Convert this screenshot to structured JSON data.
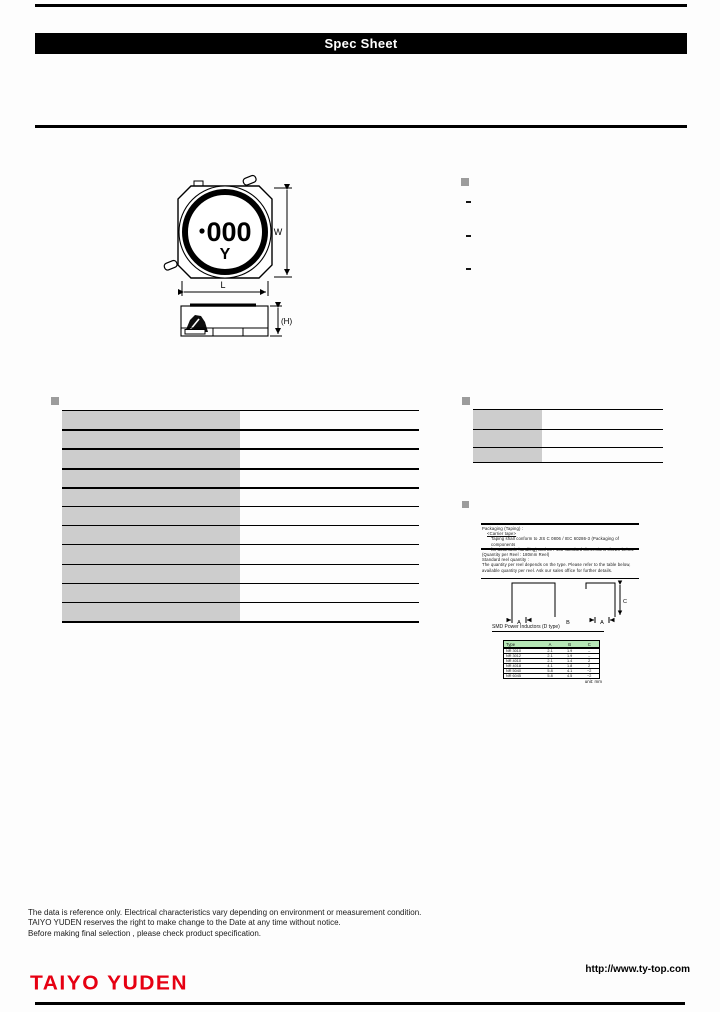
{
  "titlebar": {
    "label": "Spec Sheet"
  },
  "drawing": {
    "marking_dot": "•",
    "marking_code": "000",
    "marking_letter": "Y",
    "dim_width_label": "W",
    "dim_length_label": "L",
    "dim_height_label": "(H)"
  },
  "side_notes": {
    "dash1": "-",
    "dash2": "-",
    "dash3": "-"
  },
  "packaging": {
    "intro_lines": [
      "Packaging (Taping) :",
      "<Carrier tape>",
      "Taping shall conform to JIS C 0806 / IEC 60286-3 (Packaging of components",
      "for automatic handling) and EIA-481 standard dimensions shown below."
    ],
    "quantity_lines": [
      "(Quantity per Reel : 180mm Reel)",
      "Standard reel quantity :",
      "The quantity per reel depends on the type. Please refer to the table below,",
      "available quantity per reel. Ask our sales office for further details."
    ],
    "diagram": {
      "dim_a_left": "A",
      "dim_b": "B",
      "dim_a_right": "A",
      "dim_c": "C"
    },
    "table_title": "SMD Power Inductors (D type)",
    "table": {
      "headers": [
        "Type",
        "A",
        "B",
        "C"
      ],
      "rows": [
        [
          "NR 3010",
          "2.1",
          "1.9",
          "–"
        ],
        [
          "NR 3012",
          "2.1",
          "1.9",
          "–"
        ],
        [
          "NR 4010",
          "2.1",
          "1.4",
          "2"
        ],
        [
          "NR 4018",
          "4.1",
          "1.8",
          "2"
        ],
        [
          "NR 5040",
          "5.8",
          "4.1",
          "~2"
        ],
        [
          "NR 6045",
          "5.8",
          "4.5",
          "~2"
        ]
      ],
      "unit_note": "unit: mm"
    }
  },
  "disclaimer": {
    "line1": "The data is reference only. Electrical characteristics vary depending on environment or measurement condition.",
    "line2": "TAIYO YUDEN reserves the right to make change to the Date at any time without notice.",
    "line3": "Before making final selection , please check product specification."
  },
  "footer": {
    "brand": "TAIYO YUDEN",
    "url": "http://www.ty-top.com"
  },
  "colors": {
    "brand_red": "#e60012",
    "table_cell_gray": "#cdcdcd",
    "green_header": "#b6e7b6",
    "bullet_gray": "#9c9c9c"
  }
}
